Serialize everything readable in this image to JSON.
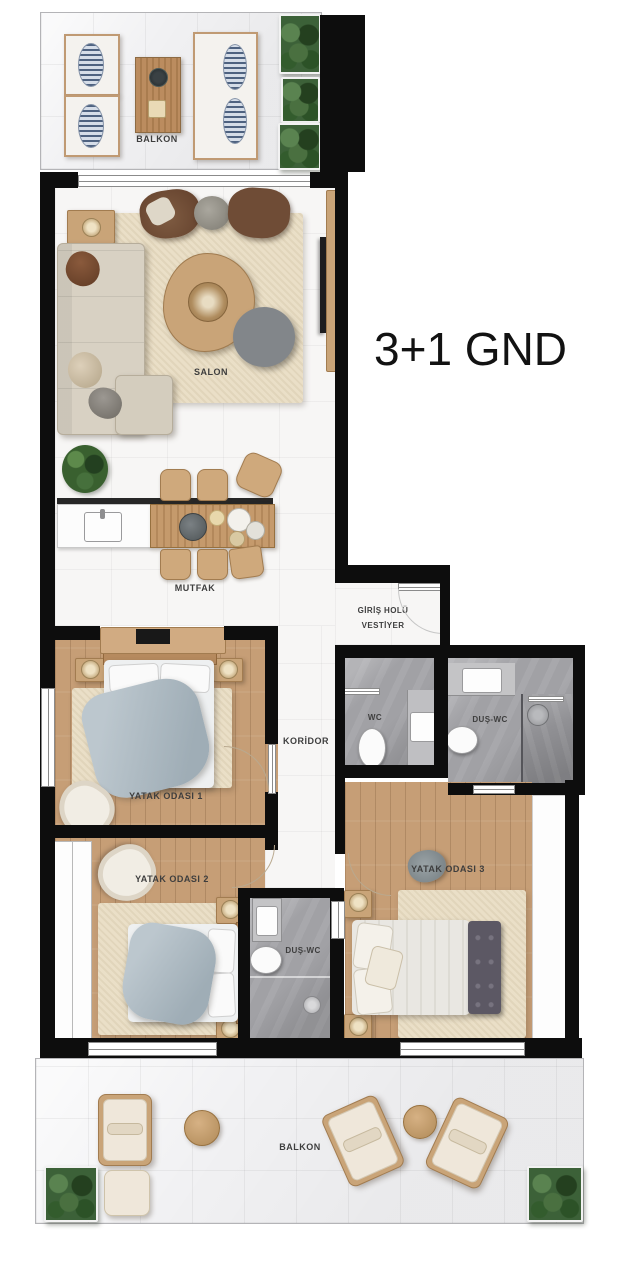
{
  "title": "3+1 GND",
  "rooms": {
    "balkon_ust": {
      "label": "BALKON"
    },
    "salon": {
      "label": "SALON"
    },
    "mutfak": {
      "label": "MUTFAK"
    },
    "giris": {
      "line1": "GİRİŞ HOLÜ",
      "line2": "VESTİYER"
    },
    "koridor": {
      "label": "KORİDOR"
    },
    "wc": {
      "label": "WC"
    },
    "dus_wc_ust": {
      "label": "DUŞ-WC"
    },
    "dus_wc_orta": {
      "label": "DUŞ-WC"
    },
    "yatak1": {
      "label": "YATAK ODASI 1"
    },
    "yatak2": {
      "label": "YATAK ODASI 2"
    },
    "yatak3": {
      "label": "YATAK ODASI 3"
    },
    "balkon_alt": {
      "label": "BALKON"
    }
  },
  "colors": {
    "wall": "#0d0d0d",
    "wood_floor": "#c69e76",
    "balcony_tile": "#f1f1f3",
    "bath_tile": "#a1a1a5",
    "rug": "#eadfc7",
    "sofa": "#d8d1c3",
    "accent_chair": "#7a573f",
    "duvet": "#aab6bf",
    "plant": "#3c6138",
    "bench": "#5c5864",
    "label_text": "#3e3e3e"
  }
}
